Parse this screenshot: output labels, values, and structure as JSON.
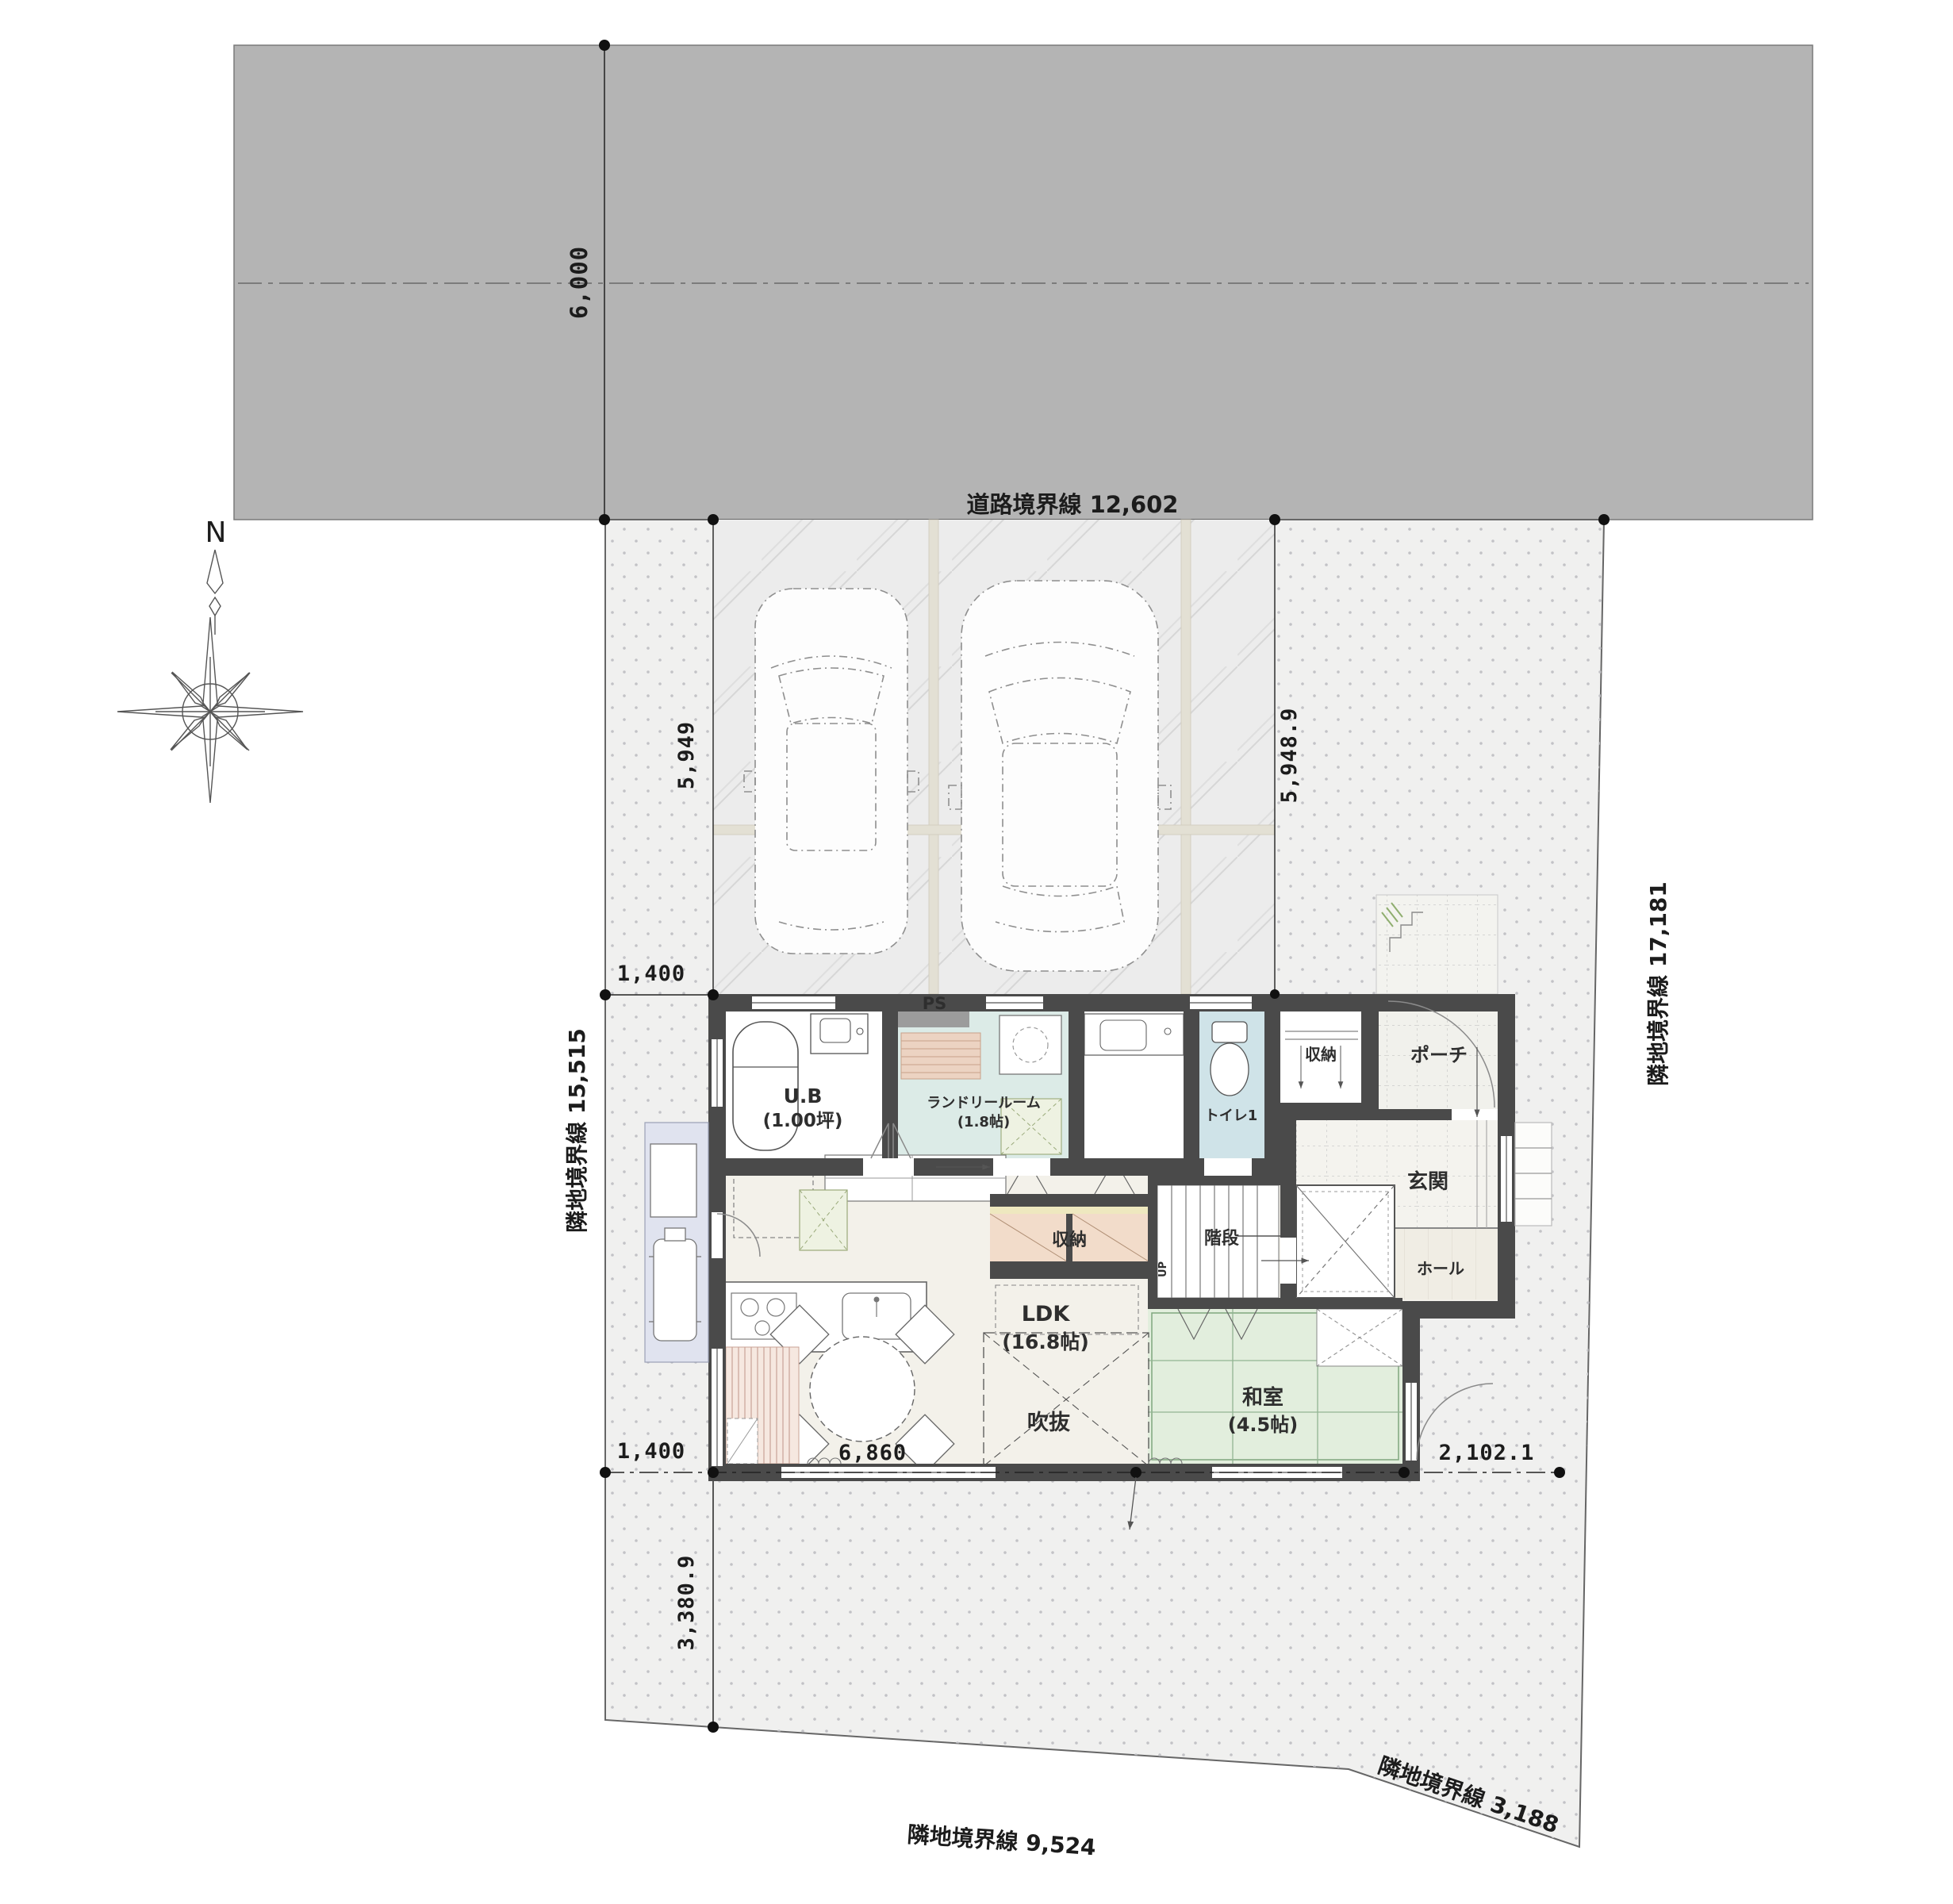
{
  "compass": {
    "north_label": "N"
  },
  "road": {
    "boundary_label": "道路境界線 12,602",
    "width_dim": "6,000"
  },
  "boundaries": {
    "left": "隣地境界線 15,515",
    "right": "隣地境界線 17,181",
    "bottom": "隣地境界線 9,524",
    "bottom_right": "隣地境界線 3,188"
  },
  "dimensions": {
    "parking_depth_left": "5,949",
    "parking_depth_right": "5,948.9",
    "west_setback_top": "1,400",
    "west_setback_bottom": "1,400",
    "house_south_width": "6,860",
    "east_setback": "2,102.1",
    "south_setback": "3,380.9"
  },
  "rooms": {
    "ub": {
      "name": "U.B",
      "size": "(1.00坪)"
    },
    "laundry": {
      "name": "ランドリールーム",
      "size": "(1.8帖)"
    },
    "ps": {
      "name": "PS"
    },
    "toilet": {
      "name": "トイレ1"
    },
    "entry_closet": {
      "name": "収納"
    },
    "porch": {
      "name": "ポーチ"
    },
    "genkan": {
      "name": "玄関"
    },
    "hall": {
      "name": "ホール"
    },
    "stairs": {
      "name": "階段",
      "up_label": "UP"
    },
    "ldk": {
      "name": "LDK",
      "size": "(16.8帖)"
    },
    "ldk_storage": {
      "name": "収納"
    },
    "washitsu": {
      "name": "和室",
      "size": "(4.5帖)"
    },
    "void": {
      "name": "吹抜"
    }
  },
  "colors": {
    "wall": "#4a4a4a",
    "road": "#b4b4b4",
    "site_fill": "#f0f0ef",
    "floor": "#f3f1ea",
    "tatami": "#e2eedd",
    "laundry_floor": "#dcebe7",
    "toilet_floor": "#cfe3e8",
    "storage_peach": "#f2dcca",
    "terrace": "#e0e3ef"
  }
}
